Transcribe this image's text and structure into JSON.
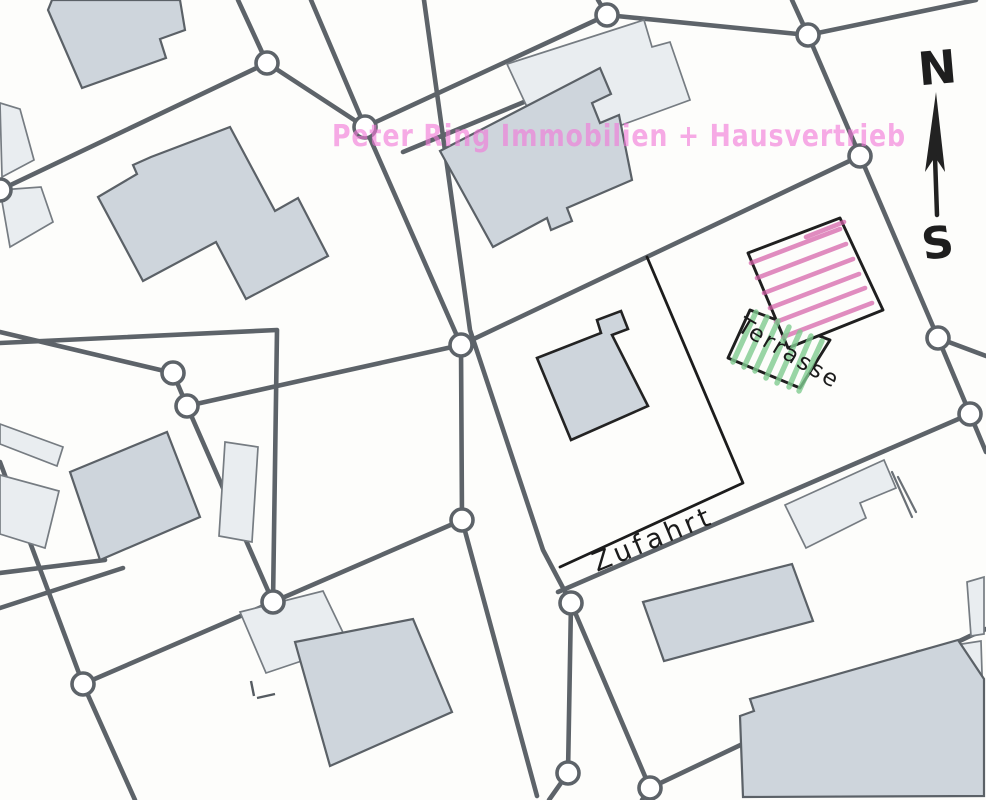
{
  "plan": {
    "watermark_text": "Peter Ring Immobilien + Hausvertrieb",
    "terrace_label": "Terrasse",
    "driveway_label": "Zufahrt",
    "compass_north": "N",
    "compass_south": "S",
    "colors": {
      "paper": "#fdfdfb",
      "boundary_line": "#5d6369",
      "pen_line": "#1c1c1c",
      "building_fill": "#ced5dc",
      "building_fill_light": "#e9edf0",
      "plot_hatch_pink": "#d45fa8",
      "terrace_hatch_green": "#7fcb90",
      "watermark_pink": "#f278d9"
    }
  }
}
